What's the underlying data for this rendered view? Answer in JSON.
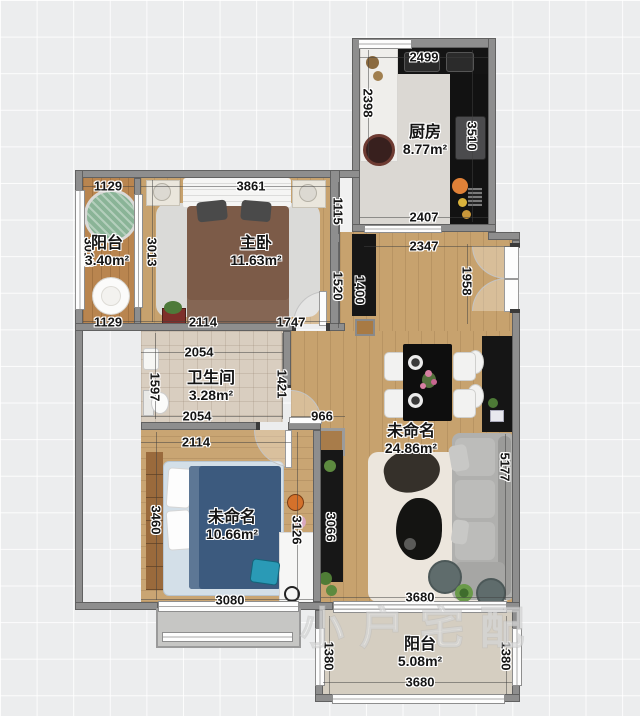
{
  "watermark": "小户宅配",
  "rooms": {
    "kitchen": {
      "name": "厨房",
      "area": "8.77m²"
    },
    "balcony_left": {
      "name": "阳台",
      "area": "3.40m²"
    },
    "master_bedroom": {
      "name": "主卧",
      "area": "11.63m²"
    },
    "bathroom": {
      "name": "卫生间",
      "area": "3.28m²"
    },
    "bedroom2": {
      "name": "未命名",
      "area": "10.66m²"
    },
    "living_room": {
      "name": "未命名",
      "area": "24.86m²"
    },
    "balcony_bottom": {
      "name": "阳台",
      "area": "5.08m²"
    }
  },
  "dimensions": {
    "kitchen_top": "2499",
    "kitchen_left": "2398",
    "kitchen_right": "3510",
    "kitchen_bottom": "2407",
    "balcony_left_top": "1129",
    "balcony_left_bottom": "1129",
    "balcony_left_side": "3013",
    "master_top": "3861",
    "master_left": "3013",
    "master_right_upper": "1115",
    "master_right_lower": "1520",
    "master_bottom_left": "2114",
    "master_bottom_right": "1747",
    "entry_cabinet": "1400",
    "entry_top": "2347",
    "entry_right": "1958",
    "bath_top": "2054",
    "bath_left": "1597",
    "bath_right": "1421",
    "bath_bottom": "2054",
    "hall_width": "966",
    "bed2_top": "2114",
    "bed2_left": "3460",
    "bed2_right": "3126",
    "bed2_bottom": "3080",
    "tv_cabinet": "3066",
    "living_right": "5177",
    "living_bottom": "3680",
    "balcony_bottom_left": "1380",
    "balcony_bottom_right": "1380",
    "balcony_bottom_bottom": "3680"
  }
}
